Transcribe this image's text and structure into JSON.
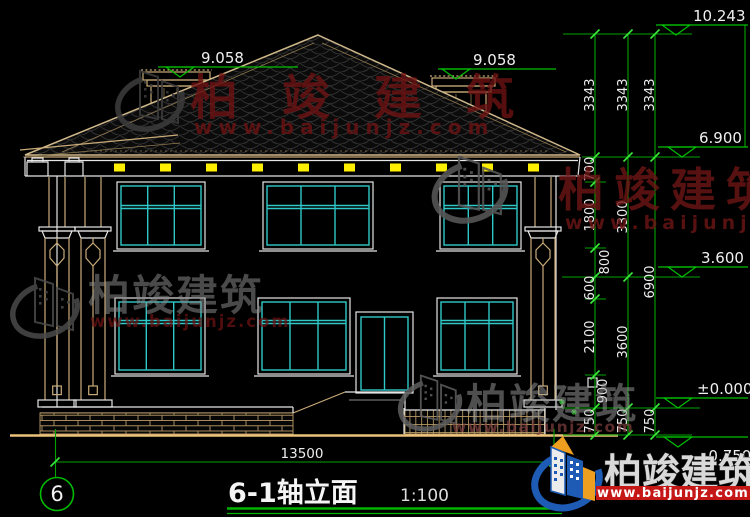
{
  "drawing": {
    "axis_bubble": "6",
    "title": "6-1轴立面",
    "scale": "1:100"
  },
  "brand": {
    "name": "柏竣建筑",
    "url": "www.baijunjz.com"
  },
  "dimensions": {
    "overall_width": "13500",
    "roof_tiers": [
      "3343",
      "3343",
      "3343"
    ],
    "inner_chain": [
      "700",
      "1800",
      "800",
      "600",
      "2100",
      "900",
      "750"
    ],
    "middle_chain": [
      "3300",
      "3600",
      "750"
    ],
    "outer_chain": [
      "6900",
      "750"
    ],
    "chimney_left_elevation": "9.058",
    "chimney_right_elevation": "9.058"
  },
  "elevations": {
    "ridge": "10.243",
    "eave": "6.900",
    "second_floor": "3.600",
    "ground_floor": "±0.000",
    "site": "-0.750"
  },
  "colors": {
    "line_cyan": "#2fc7c7",
    "line_tan": "#c9ab78",
    "dim_green": "#00c000",
    "rafter_yellow": "#ffef00",
    "watermark_red": "#6e1313",
    "logo_blue": "#1d5bb5",
    "logo_orange": "#ef9f1f",
    "banner_red": "#c61717",
    "background": "#000000"
  }
}
